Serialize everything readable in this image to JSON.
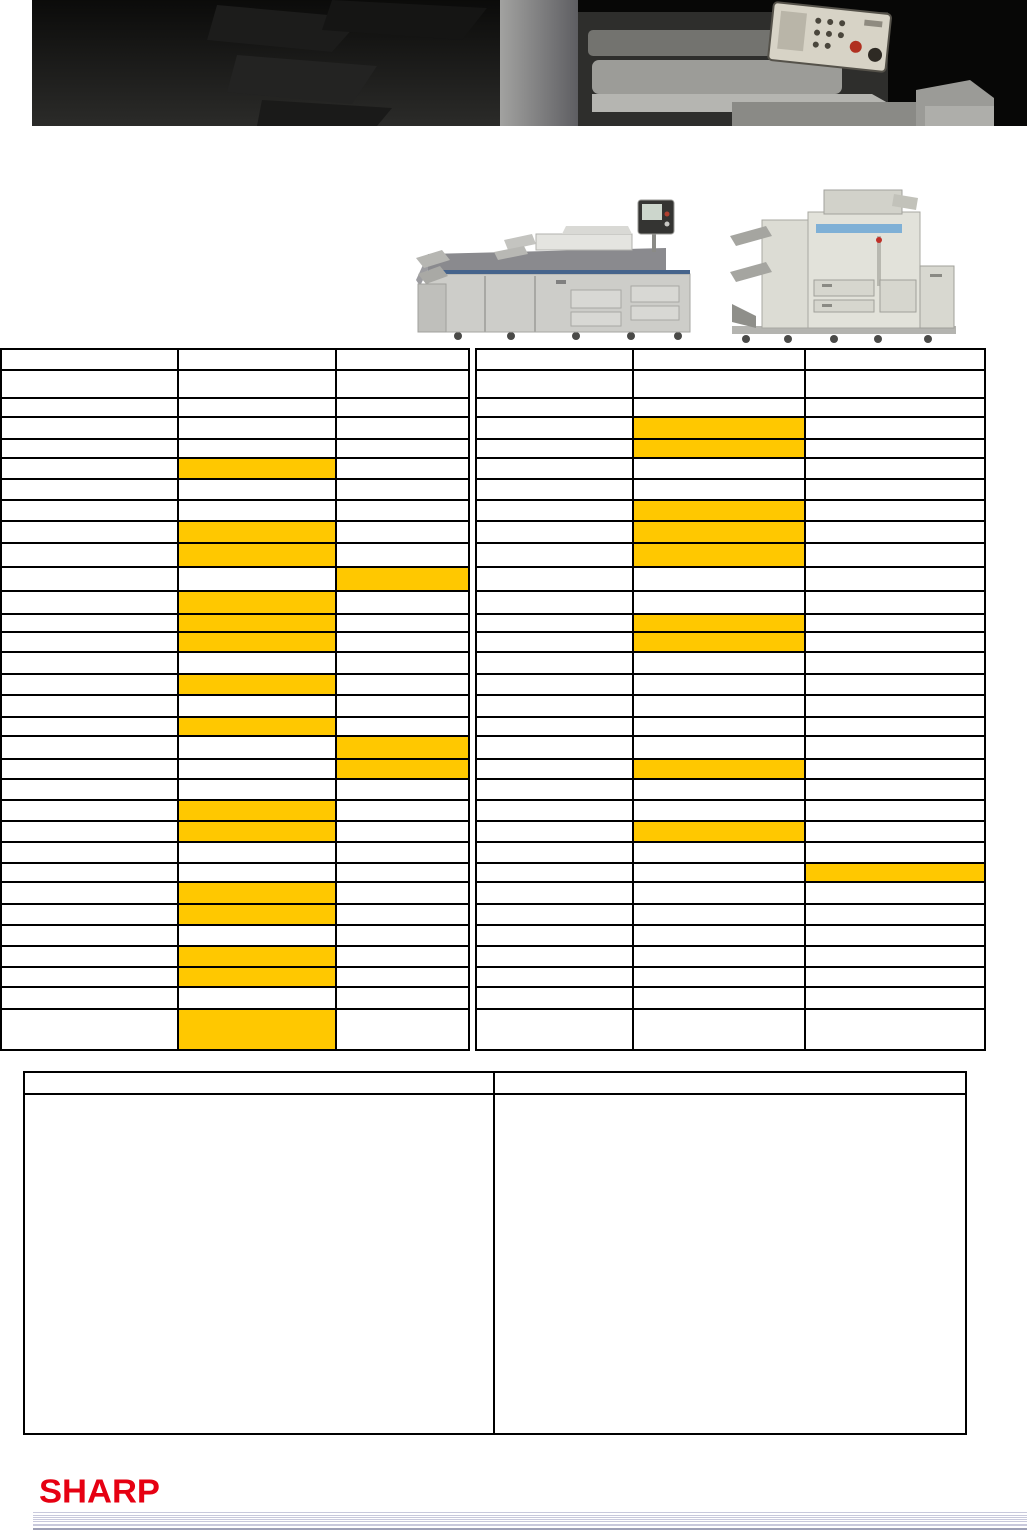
{
  "page": {
    "width": 1027,
    "height": 1532,
    "background": "#ffffff"
  },
  "brand": {
    "logo_text": "SHARP",
    "logo_color": "#e60012"
  },
  "colors": {
    "highlight": "#ffc800",
    "table_border": "#000000",
    "stripe_light": "#c8c9dc",
    "stripe_dark": "#9da0b6"
  },
  "images": {
    "hero": "dark-showroom-copiers-photo",
    "left_product": "production-printing-system-photo",
    "right_product": "digital-copier-with-finisher-photo"
  },
  "spec_tables": {
    "top": 348,
    "highlight_color": "#ffc800",
    "row_heights": [
      21,
      28,
      19,
      22,
      19,
      21,
      21,
      21,
      22,
      24,
      24,
      23,
      18,
      20,
      22,
      21,
      22,
      19,
      23,
      20,
      21,
      21,
      21,
      21,
      19,
      22,
      21,
      21,
      21,
      20,
      22,
      41
    ],
    "left_table": {
      "x": 0,
      "col_widths": [
        177,
        158,
        133
      ],
      "highlights": [
        [
          6,
          2
        ],
        [
          9,
          2
        ],
        [
          10,
          2
        ],
        [
          11,
          3
        ],
        [
          12,
          2
        ],
        [
          13,
          2
        ],
        [
          14,
          2
        ],
        [
          16,
          2
        ],
        [
          18,
          2
        ],
        [
          19,
          3
        ],
        [
          20,
          3
        ],
        [
          22,
          2
        ],
        [
          23,
          2
        ],
        [
          26,
          2
        ],
        [
          27,
          2
        ],
        [
          29,
          2
        ],
        [
          30,
          2
        ],
        [
          32,
          2
        ]
      ]
    },
    "right_table": {
      "x": 475,
      "col_widths": [
        157,
        172,
        180
      ],
      "highlights": [
        [
          4,
          2
        ],
        [
          5,
          2
        ],
        [
          8,
          2
        ],
        [
          9,
          2
        ],
        [
          10,
          2
        ],
        [
          13,
          2
        ],
        [
          14,
          2
        ],
        [
          20,
          2
        ],
        [
          23,
          2
        ],
        [
          25,
          3
        ]
      ]
    }
  },
  "notes_table": {
    "x": 23,
    "y": 1071,
    "width": 944,
    "height": 364,
    "header_height": 22,
    "first_col_width": 470
  },
  "footer": {
    "stripes_x": 33,
    "stripes_width": 994,
    "stripes": [
      {
        "top": 1512,
        "h": 1,
        "dark": false
      },
      {
        "top": 1515,
        "h": 1,
        "dark": false
      },
      {
        "top": 1517,
        "h": 1,
        "dark": false
      },
      {
        "top": 1519,
        "h": 1,
        "dark": false
      },
      {
        "top": 1521,
        "h": 1,
        "dark": false
      },
      {
        "top": 1524,
        "h": 2,
        "dark": false
      },
      {
        "top": 1528,
        "h": 2,
        "dark": true
      }
    ]
  }
}
